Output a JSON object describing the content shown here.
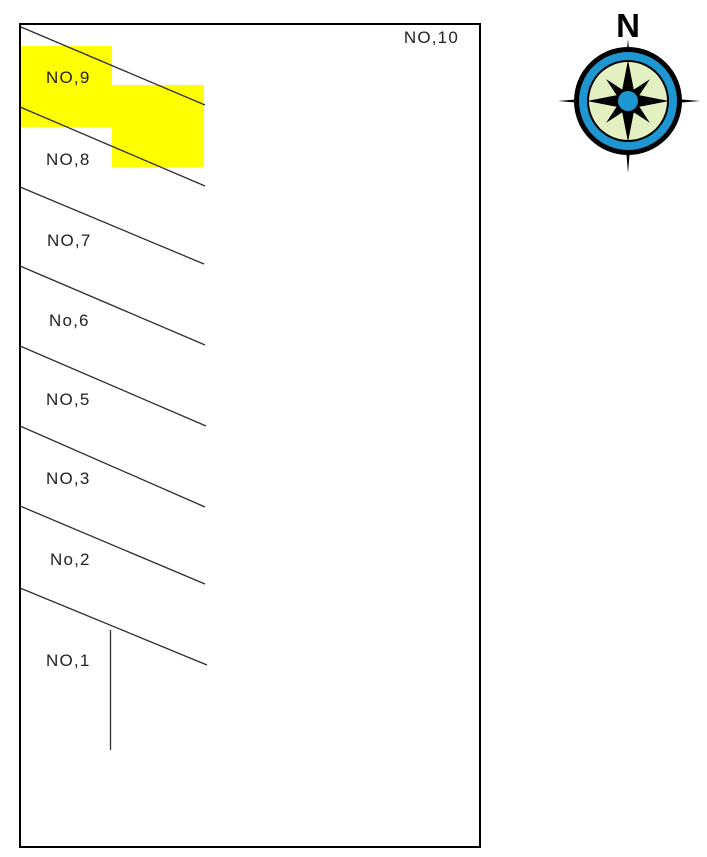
{
  "map": {
    "parcels": [
      {
        "label": "NO,10"
      },
      {
        "label": "NO,9"
      },
      {
        "label": "NO,8"
      },
      {
        "label": "NO,7"
      },
      {
        "label": "No,6"
      },
      {
        "label": "NO,5"
      },
      {
        "label": "NO,3"
      },
      {
        "label": "No,2"
      },
      {
        "label": "NO,1"
      }
    ],
    "highlight_color": "#ffff00",
    "line_color": "#2e2e2e",
    "border_color": "#000000"
  },
  "compass": {
    "north_label": "N",
    "ring_color": "#1e96d2",
    "face_color": "#e2f0c2",
    "outline_color": "#000000",
    "center_color": "#1e96d2"
  }
}
